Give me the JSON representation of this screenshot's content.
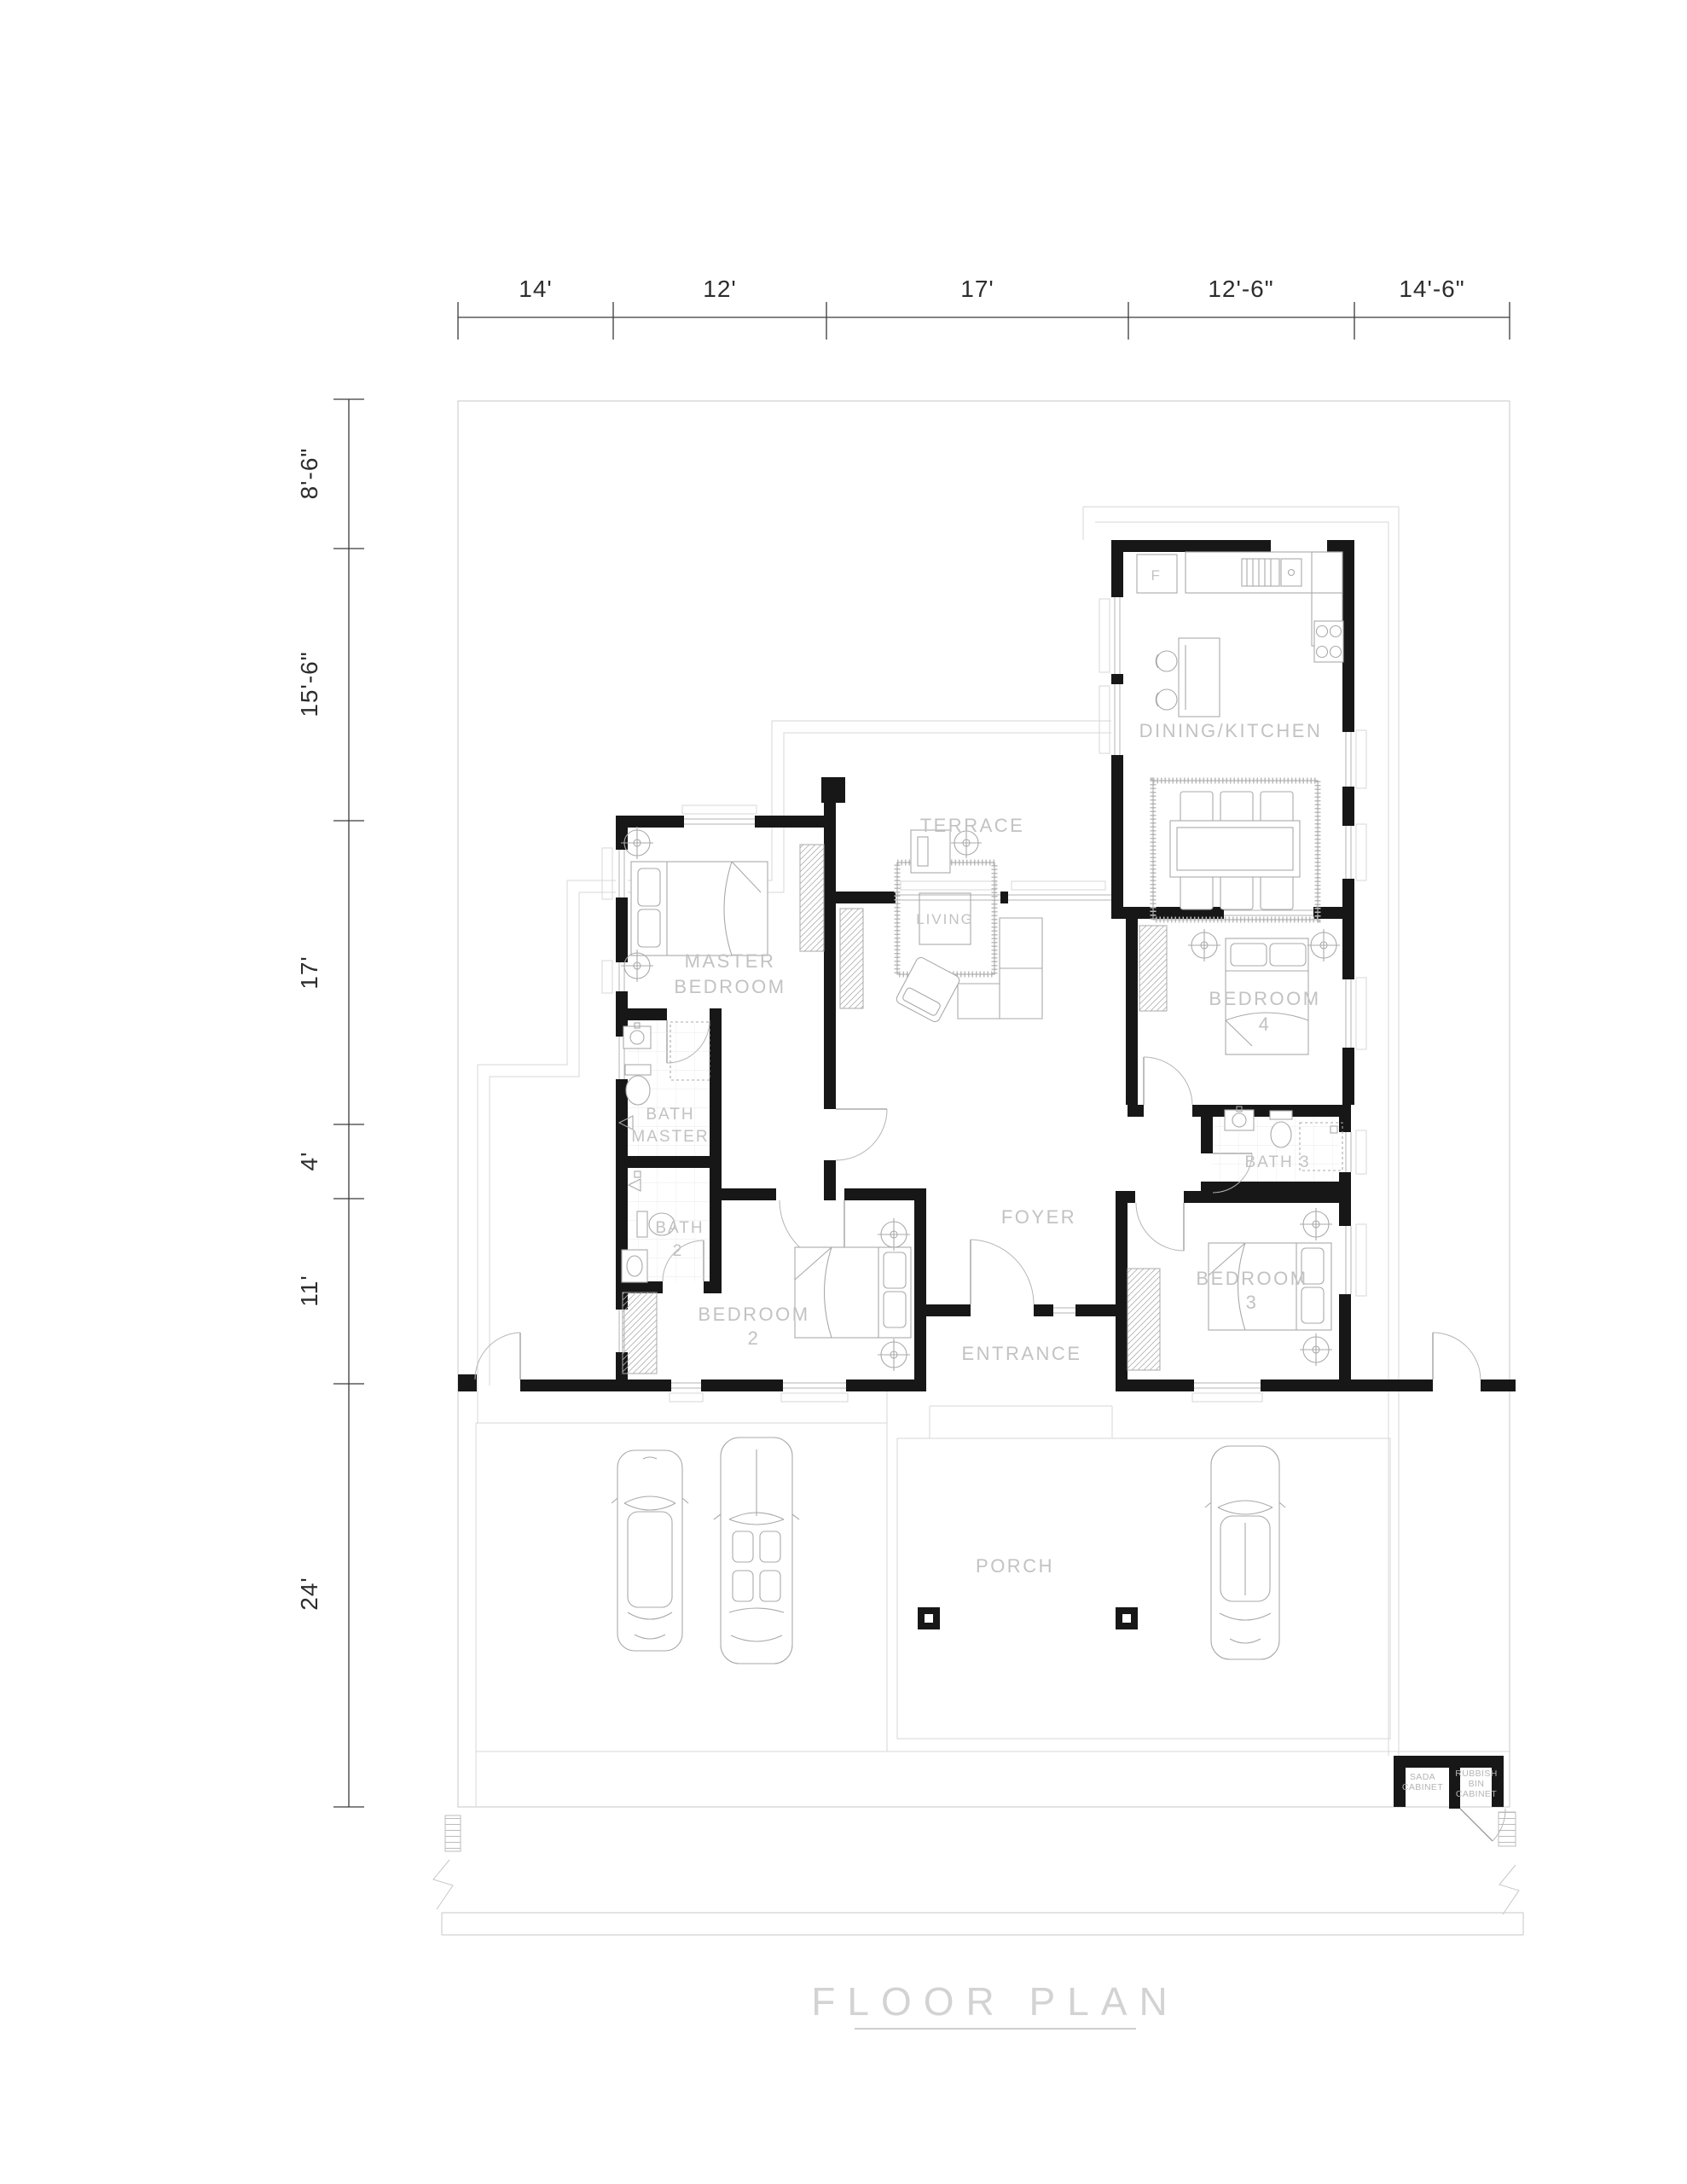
{
  "title": "FLOOR PLAN",
  "dimensions": {
    "top": [
      "14'",
      "12'",
      "17'",
      "12'-6\"",
      "14'-6\""
    ],
    "left": [
      "8'-6\"",
      "15'-6\"",
      "17'",
      "4'",
      "11'",
      "24'"
    ]
  },
  "rooms": {
    "terrace": "TERRACE",
    "dining_kitchen": "DINING/KITCHEN",
    "living": "LIVING",
    "master1": "MASTER",
    "master2": "BEDROOM",
    "bath_master1": "BATH",
    "bath_master2": "MASTER",
    "bath2_1": "BATH",
    "bath2_2": "2",
    "bath3": "BATH 3",
    "bedroom2_1": "BEDROOM",
    "bedroom2_2": "2",
    "bedroom3_1": "BEDROOM",
    "bedroom3_2": "3",
    "bedroom4_1": "BEDROOM",
    "bedroom4_2": "4",
    "foyer": "FOYER",
    "entrance": "ENTRANCE",
    "porch": "PORCH"
  },
  "labels": {
    "fridge": "F",
    "gas_cabinet": [
      "SADA",
      "CABINET"
    ],
    "rubbish_cabinet": [
      "RUBBISH",
      "BIN",
      "CABINET"
    ]
  }
}
